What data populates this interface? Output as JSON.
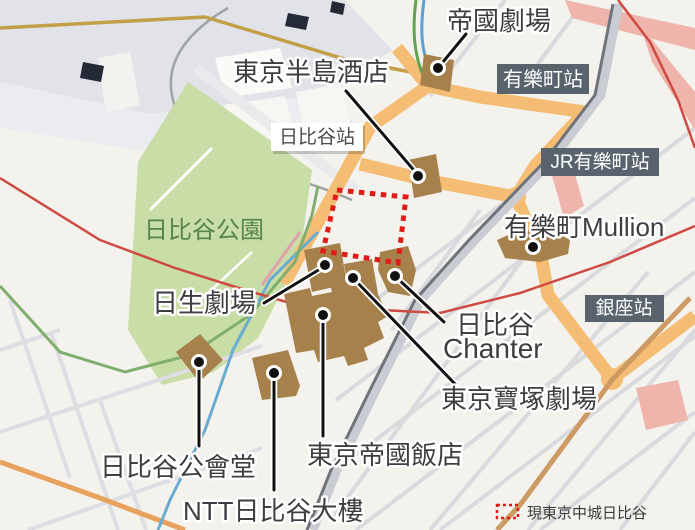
{
  "park": {
    "label": "日比谷公園"
  },
  "stations": {
    "hibiya": "日比谷站",
    "yurakucho": "有樂町站",
    "jr_yurakucho": "JR有樂町站",
    "ginza": "銀座站"
  },
  "landmarks": {
    "teikoku_gekijo": "帝國劇場",
    "peninsula_tokyo": "東京半島酒店",
    "mullion": "有樂町Mullion",
    "nissay_theatre": "日生劇場",
    "chanter_line1": "日比谷",
    "chanter_line2": "Chanter",
    "takarazuka": "東京寶塚劇場",
    "imperial_hotel": "東京帝國飯店",
    "kokaido": "日比谷公會堂",
    "ntt_building": "NTT日比谷大樓"
  },
  "legend": {
    "midtown_site": "現東京中城日比谷"
  },
  "colors": {
    "park_green": "#c9dda6",
    "building_brown": "#a6814c",
    "main_road_orange": "#f5bd73",
    "badge_gray": "#59636d",
    "site_red": "#e11b17",
    "rail_red": "#cf4a42"
  }
}
